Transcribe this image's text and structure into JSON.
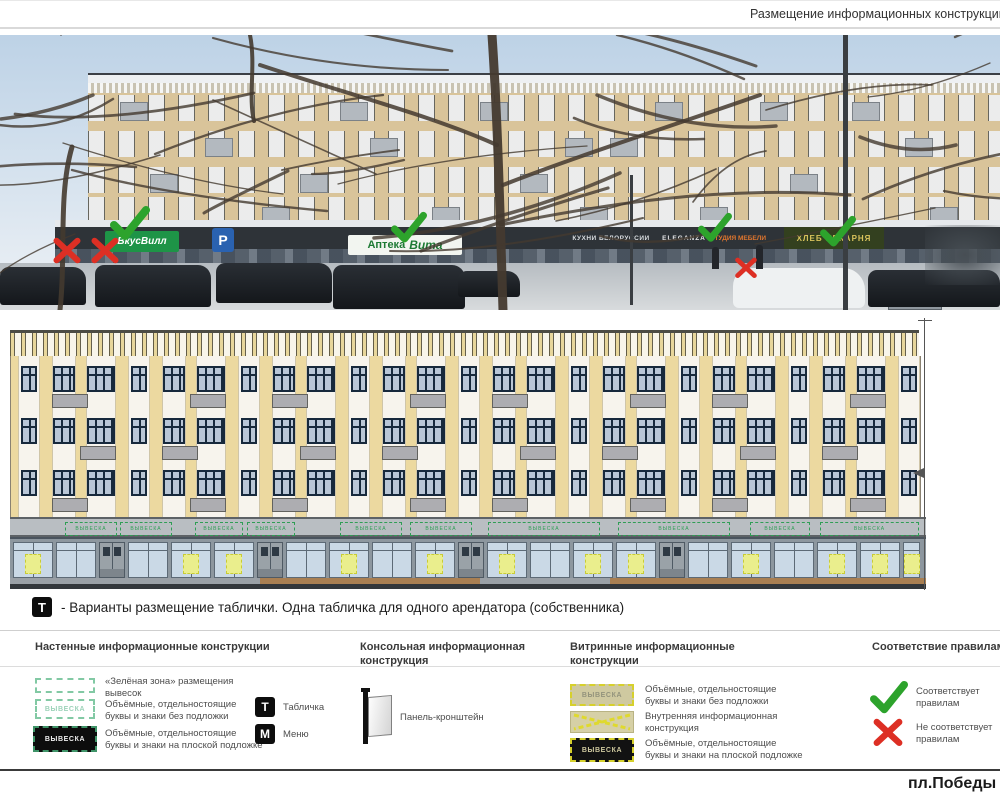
{
  "page": {
    "title": "Размещение информационных конструкций",
    "footer": "пл.Победы"
  },
  "note": {
    "t_badge": "Т",
    "text": "- Варианты размещение таблички. Одна табличка для одного арендатора (собственника)"
  },
  "photo": {
    "signs": {
      "vkusvill": {
        "text": "ВкусВилл",
        "bg": "#1e9447",
        "color": "#ffffff"
      },
      "parking": {
        "text": "Р",
        "bg": "#2a62b0",
        "color": "#ffffff"
      },
      "apteka": {
        "text": "Аптека",
        "text2": "Вита",
        "bg": "#f2f5f0",
        "color": "#1d7a34"
      },
      "kuhni": {
        "text": "КУХНИ БЕЛОРУССИИ",
        "color": "#d8dcdf"
      },
      "eleganza": {
        "text": "ELEGANZA",
        "color": "#e8e8ea"
      },
      "mebel": {
        "text": "СТУДИЯ МЕБЕЛИ",
        "color": "#e0762e"
      },
      "bakery": {
        "text": "ХЛЕБ ПЕКАРНЯ",
        "bg": "#33401f",
        "color": "#d9c35c"
      }
    },
    "marks": [
      {
        "type": "cross",
        "x": 52,
        "y": 202,
        "s": 30
      },
      {
        "type": "cross",
        "x": 90,
        "y": 202,
        "s": 30
      },
      {
        "type": "check",
        "x": 110,
        "y": 170,
        "s": 40
      },
      {
        "type": "check",
        "x": 391,
        "y": 176,
        "s": 36
      },
      {
        "type": "check",
        "x": 698,
        "y": 177,
        "s": 34
      },
      {
        "type": "check",
        "x": 820,
        "y": 180,
        "s": 36
      },
      {
        "type": "cross",
        "x": 734,
        "y": 222,
        "s": 24
      }
    ]
  },
  "elevation": {
    "fascia_sign_label": "ВЫВЕСКА",
    "zones": [
      {
        "x": 55,
        "w": 50
      },
      {
        "x": 110,
        "w": 50
      },
      {
        "x": 185,
        "w": 46
      },
      {
        "x": 237,
        "w": 46
      },
      {
        "x": 330,
        "w": 60
      },
      {
        "x": 400,
        "w": 60
      },
      {
        "x": 478,
        "w": 110
      },
      {
        "x": 608,
        "w": 110
      },
      {
        "x": 740,
        "w": 58
      },
      {
        "x": 810,
        "w": 97
      }
    ]
  },
  "legend": {
    "wall": {
      "title": "Настенные информационные конструкции",
      "items": [
        {
          "label": "«Зелёная зона» размещения вывесок"
        },
        {
          "swatch_text": "ВЫВЕСКА",
          "label": "Объёмные, отдельностоящие буквы и знаки без подложки"
        },
        {
          "swatch_text": "ВЫВЕСКА",
          "label": "Объёмные, отдельностоящие буквы и знаки на плоской подложке"
        }
      ],
      "badges": [
        {
          "badge": "Т",
          "label": "Табличка"
        },
        {
          "badge": "М",
          "label": "Меню"
        }
      ]
    },
    "console": {
      "title": "Консольная информационная конструкция",
      "items": [
        {
          "label": "Панель-кронштейн"
        }
      ]
    },
    "vitrine": {
      "title": "Витринные информационные конструкции",
      "items": [
        {
          "swatch_text": "ВЫВЕСКА",
          "label": "Объёмные, отдельностоящие буквы и знаки без подложки"
        },
        {
          "label": "Внутренняя информационная конструкция"
        },
        {
          "swatch_text": "ВЫВЕСКА",
          "label": "Объёмные, отдельностоящие буквы и знаки на плоской подложке"
        }
      ]
    },
    "compliance": {
      "title": "Соответствие правилам",
      "items": [
        {
          "type": "check",
          "label": "Соответствует правилам"
        },
        {
          "type": "cross",
          "label": "Не соответствует правилам"
        }
      ]
    }
  },
  "colors": {
    "check_green": "#2da32c",
    "cross_red": "#dd2f24",
    "facade_tan": "#ecd9a0",
    "zone_green": "#2f9e55",
    "vitrine_yellow": "#d6d02c"
  }
}
